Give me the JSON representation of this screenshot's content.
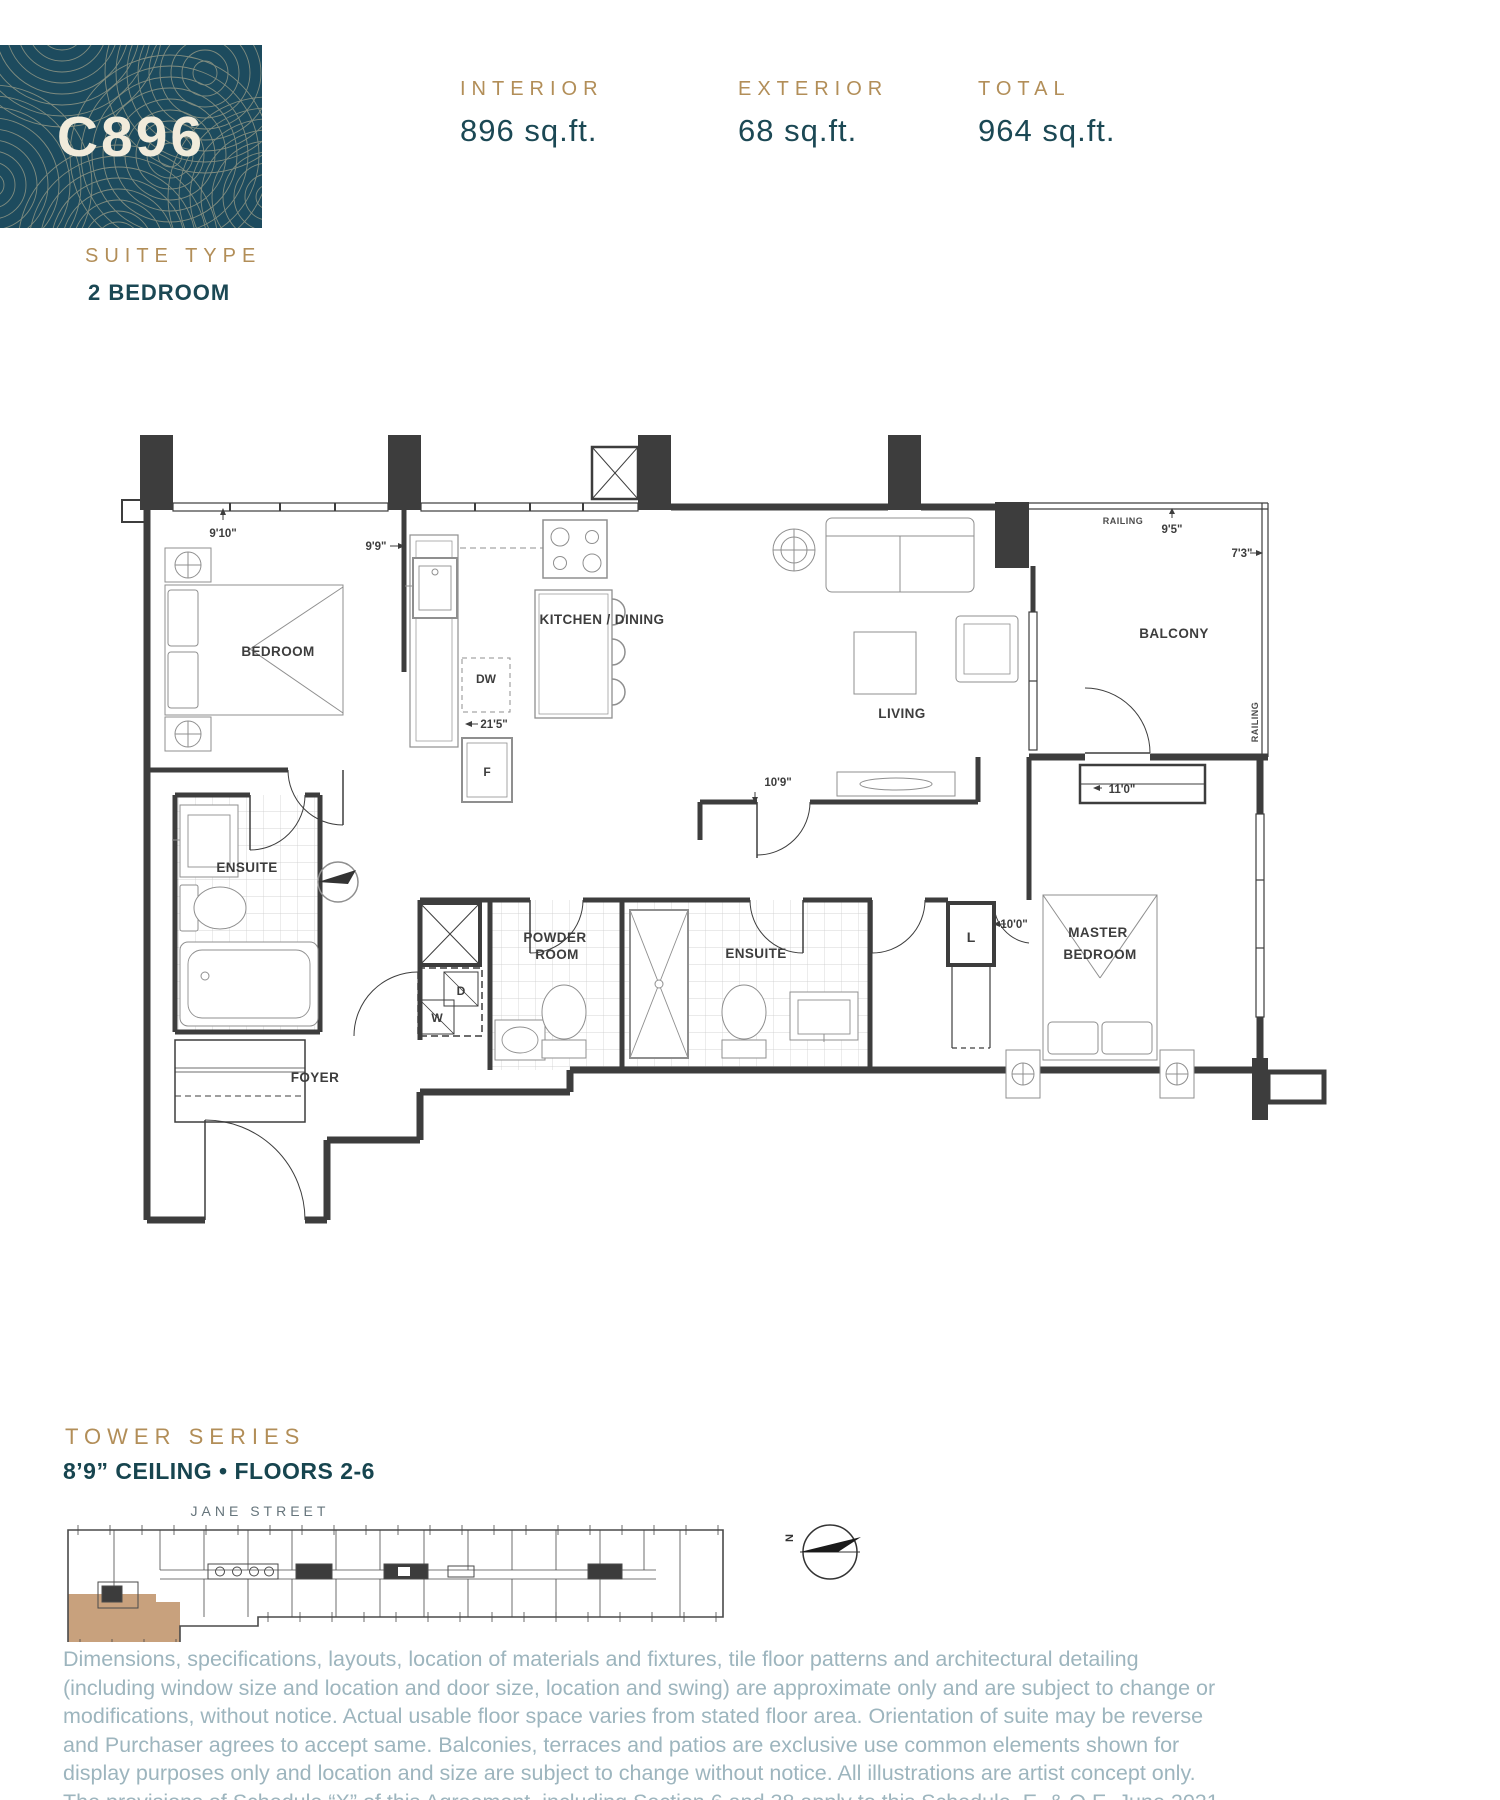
{
  "unit": {
    "code": "C896"
  },
  "suite_type": {
    "label": "SUITE TYPE",
    "value": "2 BEDROOM"
  },
  "stats": [
    {
      "label": "INTERIOR",
      "value": "896 sq.ft."
    },
    {
      "label": "EXTERIOR",
      "value": "68 sq.ft."
    },
    {
      "label": "TOTAL",
      "value": "964 sq.ft."
    }
  ],
  "plan": {
    "rooms": {
      "bedroom": "BEDROOM",
      "kitchen": "KITCHEN / DINING",
      "living": "LIVING",
      "balcony": "BALCONY",
      "master1": "MASTER",
      "master2": "BEDROOM",
      "ensuite1": "ENSUITE",
      "ensuite2": "ENSUITE",
      "powder1": "POWDER",
      "powder2": "ROOM",
      "foyer": "FOYER"
    },
    "dims": {
      "bedroom_w": "9'10\"",
      "bedroom_d": "9'9\"",
      "kitchen": "21'5\"",
      "living": "10'9\"",
      "closet": "11'0\"",
      "balcony_w": "9'5\"",
      "balcony_d": "7'3\"",
      "master": "10'0\""
    },
    "labels": {
      "railing_top": "RAILING",
      "railing_side": "RAILING",
      "dw": "DW",
      "fridge": "F",
      "washer": "W",
      "dryer": "D",
      "linen": "L"
    }
  },
  "keyplan": {
    "street": "JANE STREET",
    "north": "N"
  },
  "series": {
    "label": "TOWER SERIES",
    "ceiling": "8’9” CEILING • FLOORS 2-6"
  },
  "colors": {
    "brand_teal": "#1d4b5e",
    "gold": "#b28e58",
    "highlight_tan": "#c8a17d"
  },
  "disclaimer": "Dimensions, specifications, layouts, location of materials and fixtures, tile floor patterns and architectural detailing (including window size and location and door size, location and swing) are approximate only and are subject to change or modifications, without notice. Actual usable floor space varies from stated floor area. Orientation of suite may be reverse and Purchaser agrees to accept same. Balconies, terraces and patios are exclusive use common elements shown for display purposes only and location and size are subject to change without notice. All illustrations are artist concept only. The provisions of Schedule “X” of this Agreement, including Section 6 and 38 apply to this Schedule. E. & O.E. June 2021"
}
